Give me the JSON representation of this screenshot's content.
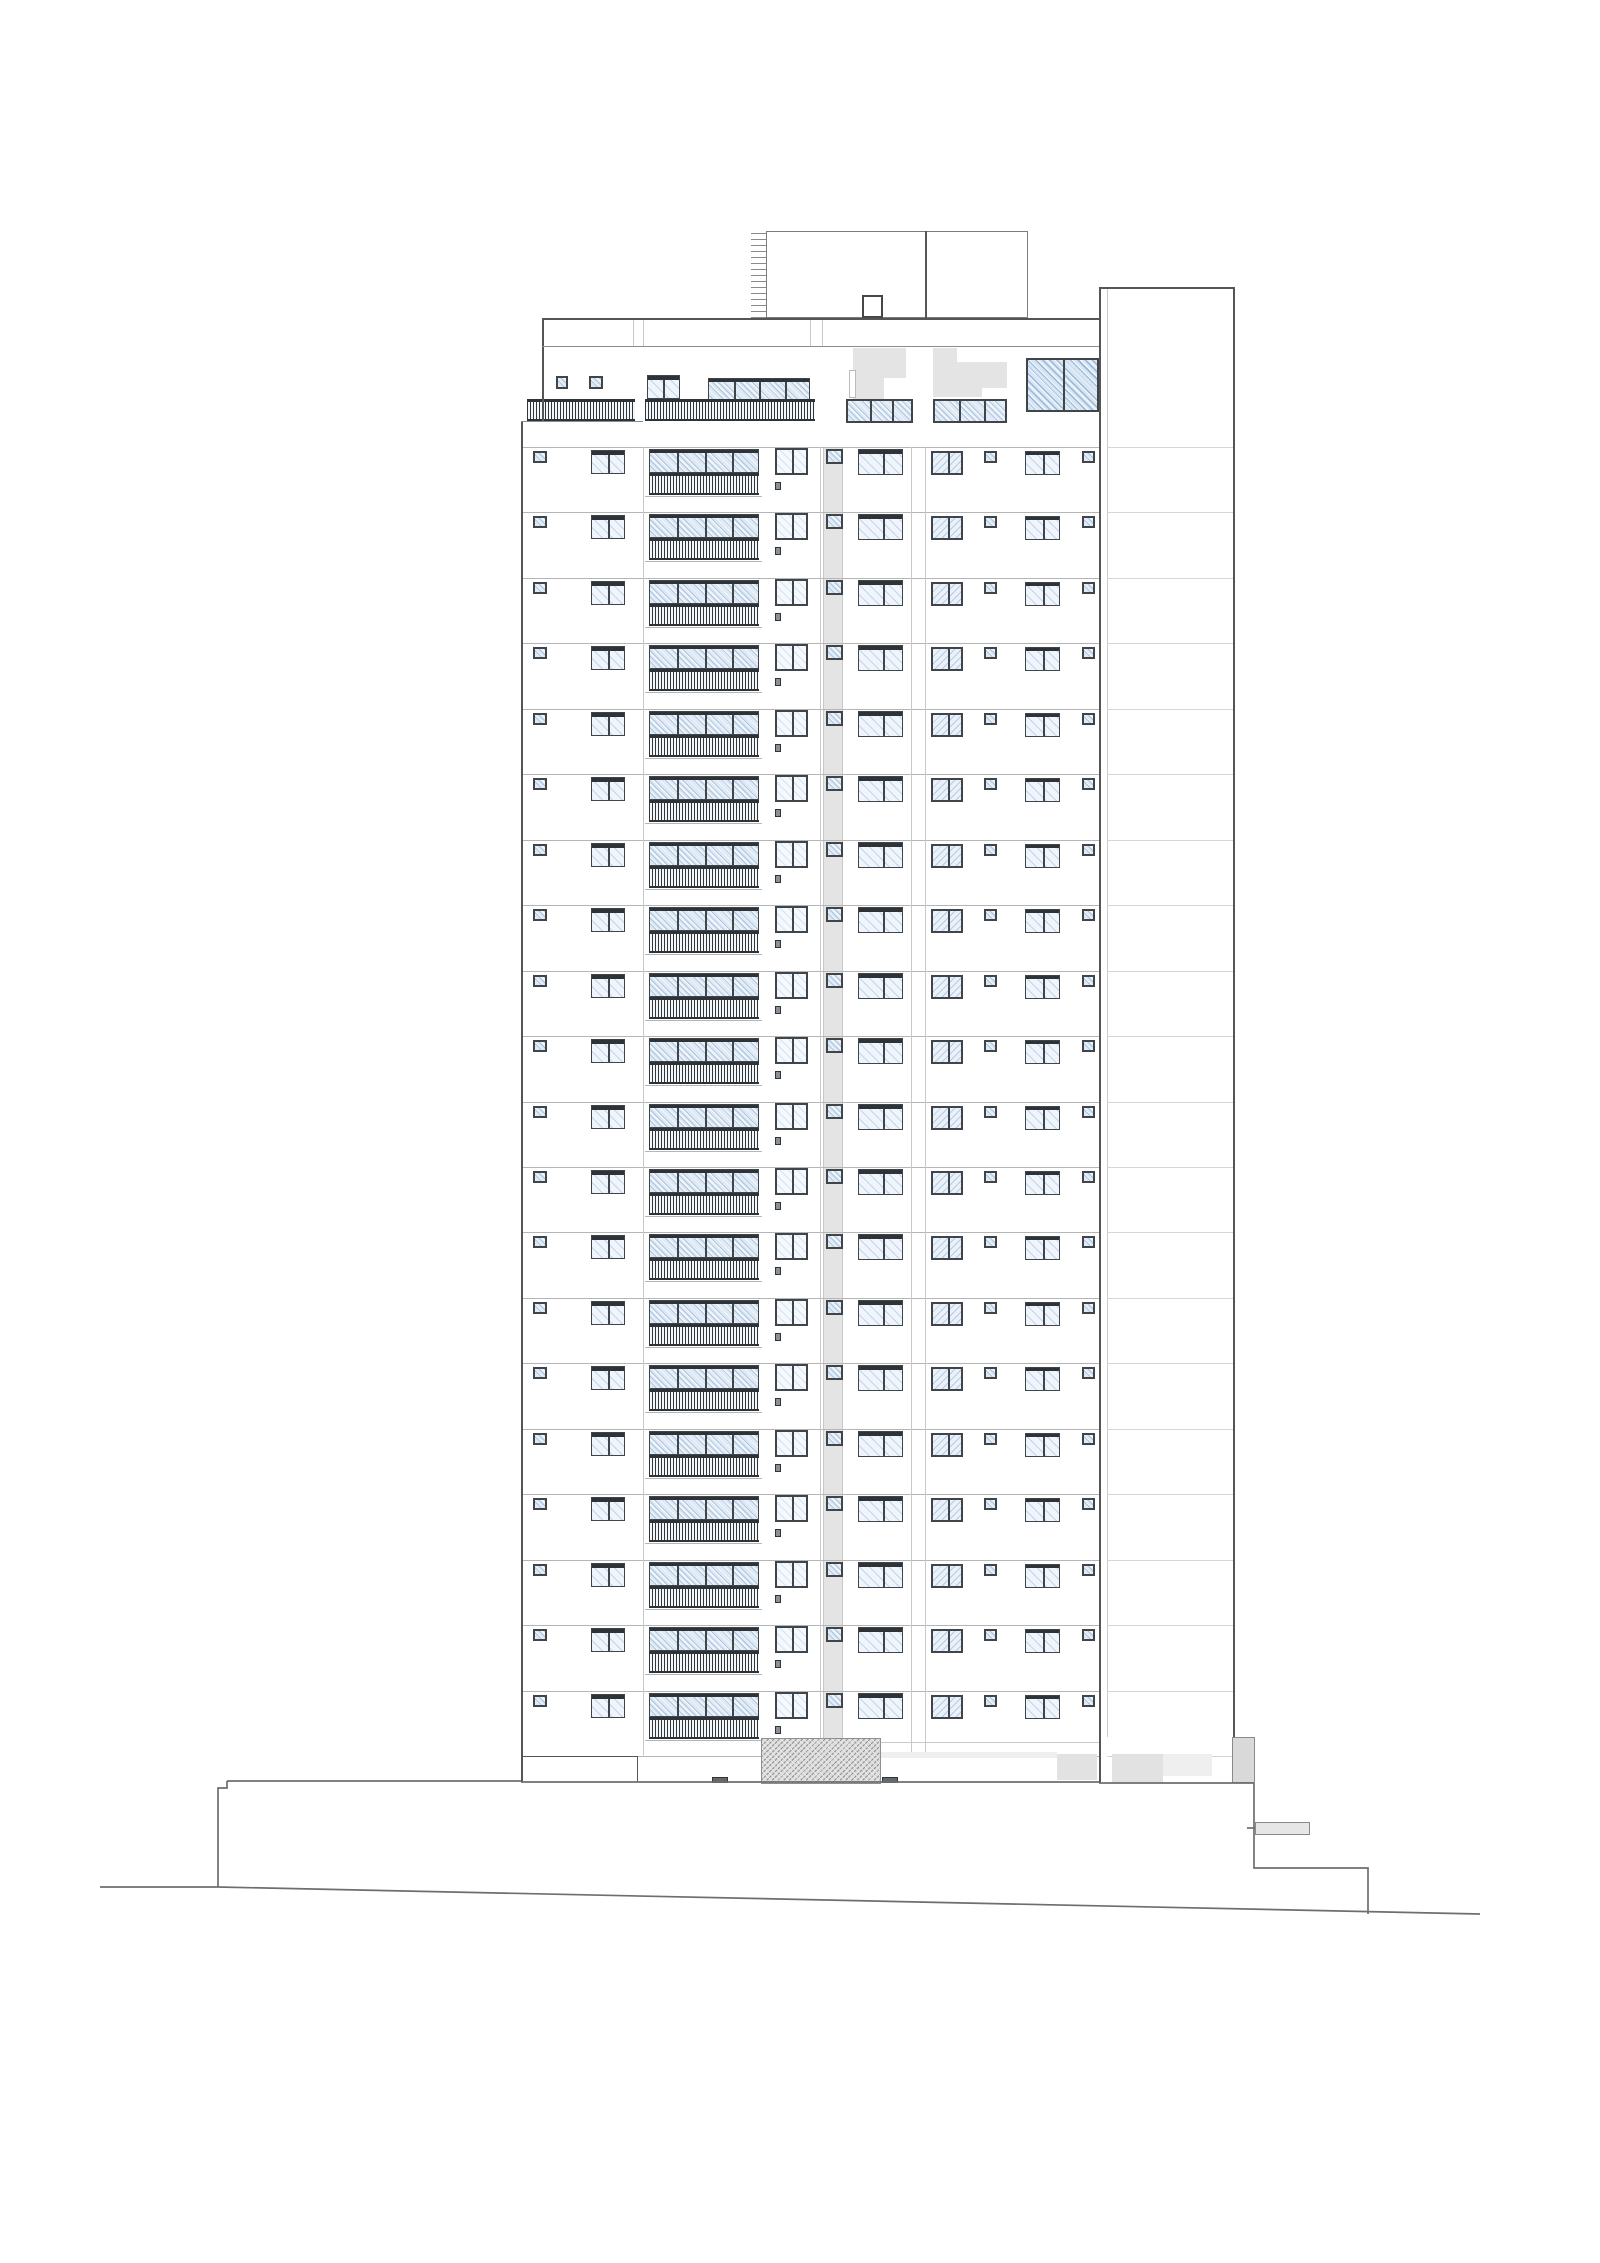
{
  "title": "High-rise residential building - front elevation line drawing",
  "canvas": {
    "width": 1600,
    "height": 2263,
    "background": "#ffffff"
  },
  "palette": {
    "outline": "#555555",
    "line_light": "#b5b5b5",
    "line_lighter": "#d6d6d6",
    "line_section": "#c9c9c9",
    "frame": "#40454a",
    "bar": "#2e3338",
    "gray_fill": "#e4e4e4",
    "gray_fill_light": "#efefef",
    "gray_fill_mid": "#e2e2e2",
    "gray_block_dark": "#d9d9d9",
    "site_line": "#6e6e6e",
    "step_fill": "#63686c",
    "flag_fill": "#e6e6e6",
    "flag_border": "#8a8a8a",
    "white": "#ffffff",
    "sliver_border": "#bbbbbb"
  },
  "roof": {
    "ladder": {
      "name": "roof-access-ladder",
      "x": 751,
      "y": 233,
      "w": 15,
      "h": 85
    },
    "box": {
      "name": "roof-machine-room",
      "x": 766,
      "y": 231,
      "w": 262,
      "h": 87,
      "divider_x": 925
    },
    "chimney": {
      "name": "roof-chimney",
      "x": 862,
      "y": 295,
      "w": 21,
      "h": 23
    }
  },
  "wing": {
    "left": 1099,
    "inner": 1107,
    "right": 1233,
    "top": 287,
    "bottom": 1737
  },
  "parapet": {
    "left": 542,
    "right": 1099,
    "top": 318,
    "bottom": 346,
    "joints": [
      633,
      643,
      810,
      822
    ]
  },
  "penthouse": {
    "top": 347,
    "terrace_line": {
      "x": 521,
      "y": 421,
      "len": 122
    },
    "grays": [
      {
        "name": "penthouse-recess-gray-1",
        "x": 853,
        "y": 348,
        "w": 60,
        "h": 51
      },
      {
        "name": "penthouse-recess-gray-2a",
        "x": 933,
        "y": 348,
        "w": 24,
        "h": 49
      },
      {
        "name": "penthouse-recess-gray-2b",
        "x": 933,
        "y": 362,
        "w": 74,
        "h": 35
      }
    ],
    "whites": [
      {
        "name": "penthouse-recess-notch-1",
        "x": 884,
        "y": 378,
        "w": 29,
        "h": 21
      },
      {
        "name": "penthouse-recess-notch-2",
        "x": 906,
        "y": 348,
        "w": 7,
        "h": 30
      },
      {
        "name": "penthouse-recess-notch-3",
        "x": 982,
        "y": 388,
        "w": 25,
        "h": 9
      },
      {
        "name": "penthouse-door-sliver",
        "x": 849,
        "y": 370,
        "w": 7,
        "h": 28,
        "border": true
      }
    ],
    "windows": [
      {
        "name": "penthouse-small-window-1",
        "type": "sq",
        "x": 556,
        "y": 376,
        "w": 12,
        "h": 13,
        "glass": "blue"
      },
      {
        "name": "penthouse-small-window-2",
        "type": "sq",
        "x": 589,
        "y": 376,
        "w": 14,
        "h": 13,
        "glass": "blue"
      },
      {
        "name": "penthouse-terrace-door",
        "type": "topbar",
        "x": 647,
        "y": 375,
        "w": 33,
        "h": 24,
        "bar": 4,
        "mull": [
          15
        ],
        "glass": "light"
      },
      {
        "name": "penthouse-balcony-glazing",
        "type": "topbar",
        "x": 708,
        "y": 378,
        "w": 102,
        "h": 42,
        "bar": 3,
        "mull": [
          25,
          50,
          76
        ],
        "glass": "blue"
      },
      {
        "name": "penthouse-window-group-a",
        "type": "framed",
        "x": 846,
        "y": 399,
        "w": 67,
        "h": 24,
        "mull": [
          22,
          44
        ],
        "glass": "blue"
      },
      {
        "name": "penthouse-window-group-b",
        "type": "framed",
        "x": 933,
        "y": 399,
        "w": 74,
        "h": 24,
        "mull": [
          24,
          49
        ],
        "glass": "blue"
      },
      {
        "name": "penthouse-large-window",
        "type": "framed",
        "x": 1026,
        "y": 358,
        "w": 73,
        "h": 54,
        "mull": [
          35
        ],
        "glass": "strong"
      }
    ],
    "railings": [
      {
        "name": "penthouse-terrace-railing-left",
        "x": 527,
        "y": 399,
        "w": 108,
        "h": 22
      },
      {
        "name": "penthouse-terrace-railing-mid",
        "x": 645,
        "y": 399,
        "w": 170,
        "h": 22
      }
    ]
  },
  "floors": {
    "count": 20,
    "first_line_y": 447,
    "spacing": 65.45,
    "left": 521,
    "right": 1099,
    "gray_strip": {
      "name": "core-recess-strip",
      "x": 823,
      "w": 20,
      "y1": 447,
      "y2": 1738
    },
    "section_lines": [
      643,
      820,
      911,
      925
    ],
    "windows": [
      {
        "name": "small-window-a",
        "type": "sq",
        "x": 533,
        "dy": 4,
        "w": 14,
        "h": 12,
        "glass": "blue"
      },
      {
        "name": "window-a",
        "type": "topbar",
        "x": 591,
        "dy": 3,
        "w": 34,
        "h": 24,
        "bar": 4,
        "mull": [
          16
        ],
        "glass": "light"
      },
      {
        "name": "balcony-glazing",
        "type": "topbar",
        "x": 649,
        "dy": 2,
        "w": 110,
        "h": 24,
        "bar": 3,
        "mull": [
          27,
          55,
          82
        ],
        "glass": "blue"
      },
      {
        "name": "balcony-railing",
        "type": "railing",
        "x": 649,
        "dy": 26,
        "w": 110,
        "h": 22
      },
      {
        "name": "window-b",
        "type": "framed",
        "x": 775,
        "dy": 1,
        "w": 33,
        "h": 27,
        "mull": [
          15
        ],
        "glass": "faint"
      },
      {
        "name": "door-detail",
        "type": "dot",
        "x": 775,
        "dy": 35,
        "w": 6,
        "h": 8
      },
      {
        "name": "core-small-window",
        "type": "sq",
        "x": 826,
        "dy": 2,
        "w": 17,
        "h": 15,
        "glass": "blue"
      },
      {
        "name": "window-c",
        "type": "topbar",
        "x": 858,
        "dy": 2,
        "w": 45,
        "h": 26,
        "bar": 4,
        "mull": [
          24
        ],
        "glass": "light"
      },
      {
        "name": "window-d",
        "type": "framed",
        "x": 931,
        "dy": 4,
        "w": 32,
        "h": 24,
        "mull": [
          15
        ],
        "glass": "back"
      },
      {
        "name": "small-window-b",
        "type": "sq",
        "x": 984,
        "dy": 4,
        "w": 13,
        "h": 12,
        "glass": "blue"
      },
      {
        "name": "window-e",
        "type": "topbar",
        "x": 1025,
        "dy": 4,
        "w": 35,
        "h": 24,
        "bar": 3,
        "mull": [
          17
        ],
        "glass": "light"
      },
      {
        "name": "small-window-c",
        "type": "sq",
        "x": 1082,
        "dy": 4,
        "w": 13,
        "h": 12,
        "glass": "blue"
      }
    ]
  },
  "edges": [
    {
      "name": "tower-left-edge",
      "kind": "v",
      "x": 521,
      "y": 421,
      "len": 1361
    },
    {
      "name": "penthouse-left-wall",
      "kind": "v",
      "x": 542,
      "y": 318,
      "len": 103
    },
    {
      "name": "tower-right-edge",
      "kind": "v",
      "x": 1099,
      "y": 287,
      "len": 1496
    },
    {
      "name": "wing-right-edge",
      "kind": "v",
      "x": 1233,
      "y": 287,
      "len": 1450
    },
    {
      "name": "parapet-top-edge",
      "kind": "h",
      "x": 542,
      "y": 318,
      "len": 557
    },
    {
      "name": "wing-top-edge",
      "kind": "h",
      "x": 1099,
      "y": 287,
      "len": 134
    },
    {
      "name": "terrace-floor-line",
      "kind": "h",
      "x": 521,
      "y": 421,
      "len": 122,
      "light": true
    },
    {
      "name": "parapet-bottom-line",
      "kind": "h",
      "x": 542,
      "y": 346,
      "len": 557,
      "light": true
    }
  ],
  "ground_floor": {
    "shapes": [
      {
        "name": "ground-lintel-line",
        "kind": "hline",
        "x": 880,
        "y": 1742,
        "len": 219,
        "color": "line_section"
      },
      {
        "name": "ground-wall-line",
        "kind": "hline",
        "x": 521,
        "y": 1756,
        "len": 116,
        "color": "outline"
      },
      {
        "name": "ground-wall-joint",
        "kind": "vline",
        "x": 637,
        "y": 1756,
        "len": 26,
        "color": "outline"
      },
      {
        "name": "ground-gray-band",
        "kind": "fill",
        "x": 881,
        "y": 1752,
        "w": 176,
        "h": 6,
        "color": "gray_fill_light"
      },
      {
        "name": "ground-gray-block-1",
        "kind": "fill",
        "x": 1057,
        "y": 1754,
        "w": 40,
        "h": 26,
        "color": "gray_fill_mid"
      },
      {
        "name": "ground-gray-block-2",
        "kind": "fill",
        "x": 1112,
        "y": 1754,
        "w": 51,
        "h": 29,
        "color": "gray_fill_mid"
      },
      {
        "name": "ground-gray-block-3",
        "kind": "fill",
        "x": 1163,
        "y": 1754,
        "w": 49,
        "h": 22,
        "color": "gray_fill_light"
      },
      {
        "name": "ground-gray-block-4",
        "kind": "fill",
        "x": 1232,
        "y": 1737,
        "w": 23,
        "h": 46,
        "color": "gray_block_dark",
        "border": true
      },
      {
        "name": "entrance-crosshatch-block",
        "kind": "crosshatch",
        "x": 761,
        "y": 1738,
        "w": 120,
        "h": 46
      },
      {
        "name": "entry-step-1",
        "kind": "step",
        "x": 712,
        "y": 1777,
        "w": 16,
        "h": 6
      },
      {
        "name": "entry-step-2",
        "kind": "step",
        "x": 882,
        "y": 1777,
        "w": 16,
        "h": 6
      },
      {
        "name": "side-canopy-bar",
        "kind": "flag",
        "x": 1255,
        "y": 1822,
        "w": 55,
        "h": 13
      }
    ]
  },
  "site": {
    "polylines": [
      {
        "name": "podium-top-left",
        "pts": [
          [
            227,
            1781
          ],
          [
            521,
            1781
          ]
        ]
      },
      {
        "name": "podium-left-step",
        "pts": [
          [
            218,
            1887
          ],
          [
            218,
            1788
          ],
          [
            227,
            1788
          ],
          [
            227,
            1781
          ]
        ]
      },
      {
        "name": "podium-top-under-tower",
        "pts": [
          [
            521,
            1782
          ],
          [
            1099,
            1782
          ]
        ]
      },
      {
        "name": "podium-top-right",
        "pts": [
          [
            1099,
            1783
          ],
          [
            1254,
            1783
          ]
        ]
      },
      {
        "name": "podium-right-edge",
        "pts": [
          [
            1254,
            1783
          ],
          [
            1254,
            1868
          ],
          [
            1368,
            1868
          ],
          [
            1368,
            1914
          ]
        ]
      },
      {
        "name": "ground-line-flat",
        "pts": [
          [
            100,
            1887
          ],
          [
            218,
            1887
          ]
        ]
      },
      {
        "name": "ground-line-slope",
        "pts": [
          [
            218,
            1887
          ],
          [
            1480,
            1914
          ]
        ]
      },
      {
        "name": "canopy-tick",
        "pts": [
          [
            1247,
            1828
          ],
          [
            1255,
            1828
          ]
        ]
      }
    ]
  }
}
